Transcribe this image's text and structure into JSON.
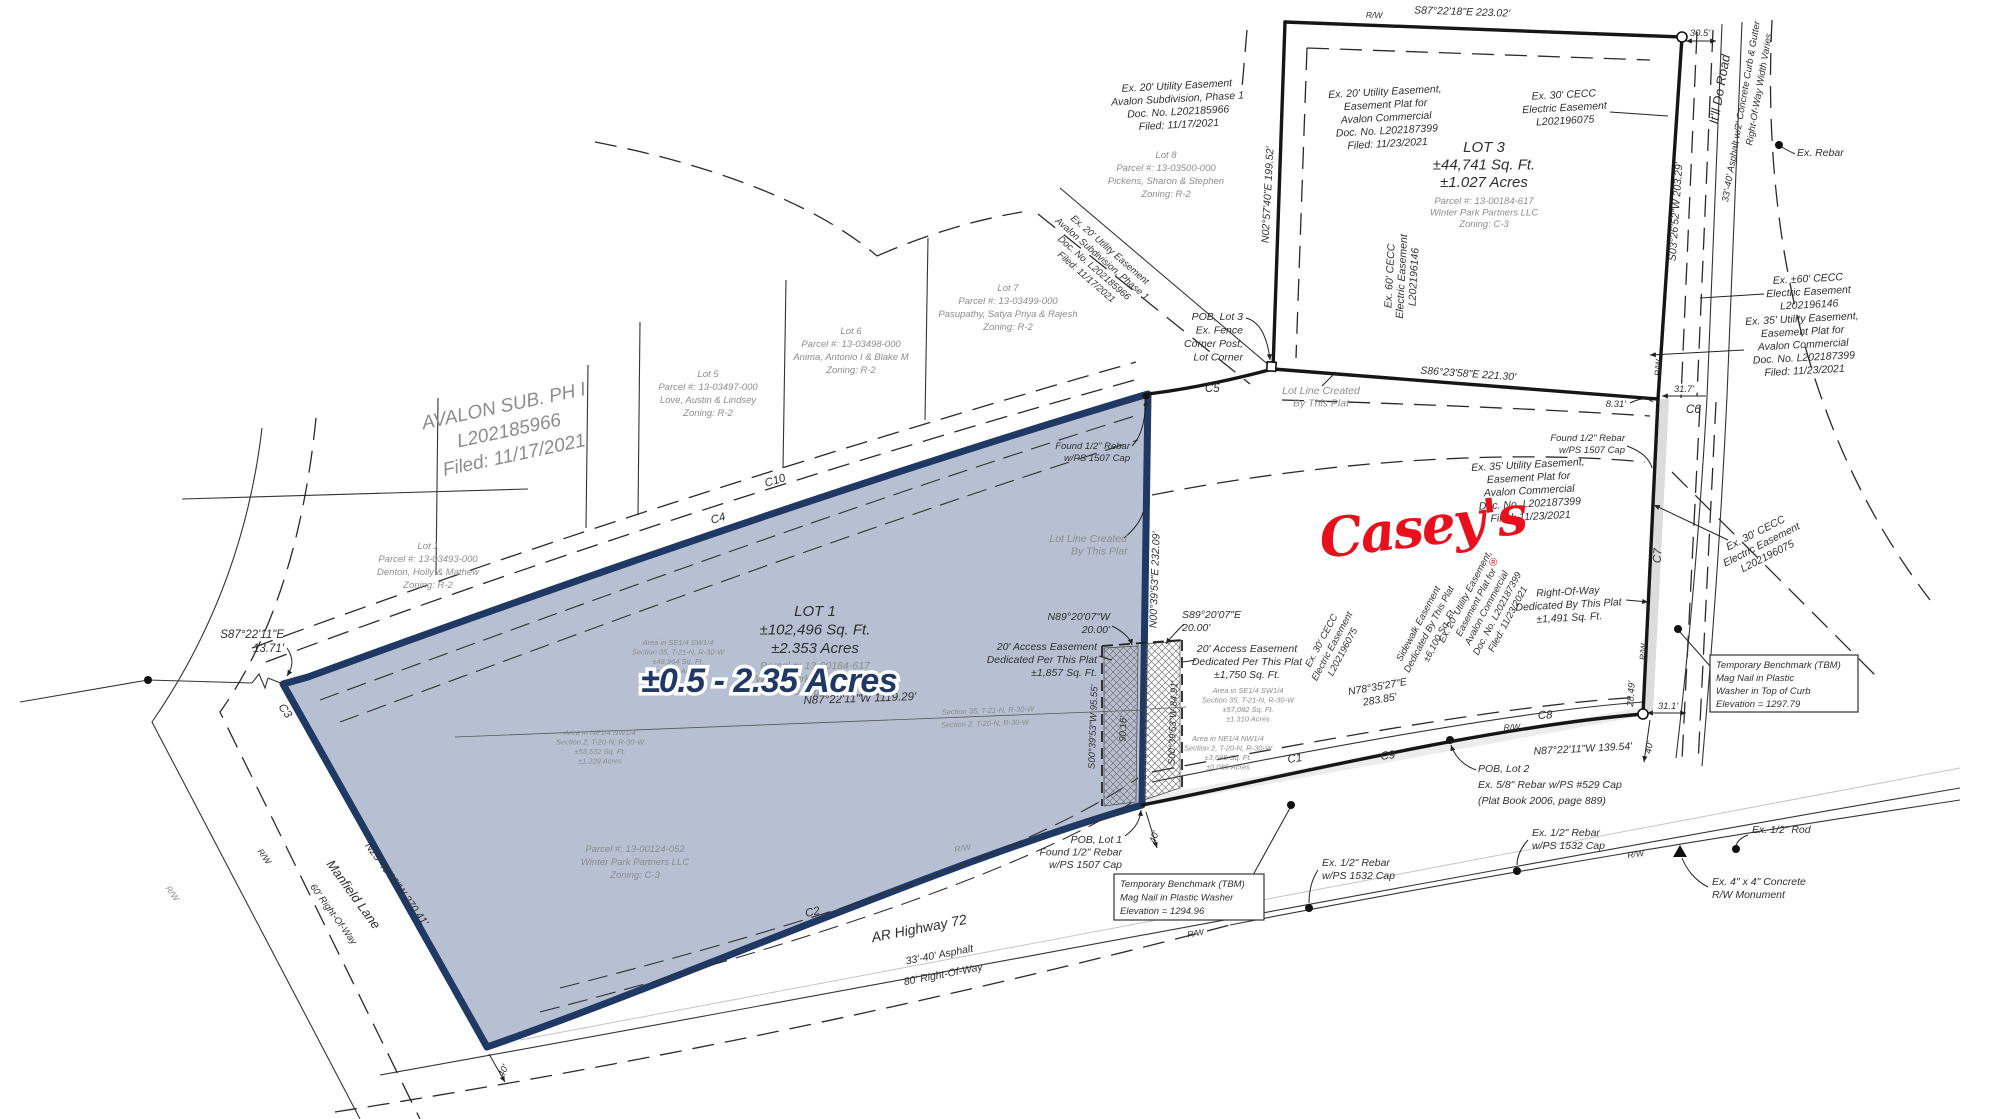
{
  "colors": {
    "lot_fill": "#b7c0d2",
    "lot_border": "#1f3864",
    "banner_navy": "#1f3864",
    "casey_red": "#e8101c",
    "gray_text": "#8c8c8c",
    "dark_text": "#2f2f2f"
  },
  "banner": {
    "text": "±0.5 - 2.35 Acres"
  },
  "brand": {
    "casey": "Casey's",
    "reg": "®"
  },
  "subdivision": {
    "avalon": [
      "AVALON SUB. PH I",
      "L202185966",
      "Filed: 11/17/2021"
    ]
  },
  "res_lots": {
    "lot1": [
      "Lot 1",
      "Parcel #: 13-03493-000",
      "Denton, Holly & Mathew",
      "Zoning: R-2"
    ],
    "lot5": [
      "Lot 5",
      "Parcel #: 13-03497-000",
      "Love, Austin & Lindsey",
      "Zoning: R-2"
    ],
    "lot6": [
      "Lot 6",
      "Parcel #: 13-03498-000",
      "Anima, Antonio I & Blake M",
      "Zoning: R-2"
    ],
    "lot7": [
      "Lot 7",
      "Parcel #: 13-03499-000",
      "Pasupathy, Satya Priya & Rajesh",
      "Zoning: R-2"
    ],
    "lot8": [
      "Lot 8",
      "Parcel #: 13-03500-000",
      "Pickens, Sharon & Stephen",
      "Zoning: R-2"
    ]
  },
  "lot1": {
    "title": [
      "LOT 1",
      "±102,496 Sq. Ft.",
      "±2.353 Acres"
    ],
    "sub": [
      "Parcel #: 13-00184-617",
      "Winter Park Partners LLC",
      "Zoning: C-3"
    ],
    "area_se": [
      "Area in SE1/4 SW1/4",
      "Section 35, T-21-N, R-30-W",
      "±48,964 Sq. Ft.",
      "±1.124 Acres"
    ],
    "area_ne": [
      "Area in NE1/4 NW1/4",
      "Section 2, T-20-N, R-30-W",
      "±53,532 Sq. Ft.",
      "±1.229 Acres"
    ],
    "parcel_low": [
      "Parcel #: 13-00124-052",
      "Winter Park Partners LLC",
      "Zoning: C-3"
    ]
  },
  "lot2": {
    "area_se": [
      "Area in SE1/4 SW1/4",
      "Section 35, T-21-N, R-30-W",
      "±57,082 Sq. Ft.",
      "±1.310 Acres"
    ],
    "area_ne": [
      "Area in NE1/4 NW1/4",
      "Section 2, T-20-N, R-30-W",
      "±3,698 Sq. Ft.",
      "±0.085 Acres"
    ]
  },
  "lot3": {
    "title": [
      "LOT 3",
      "±44,741 Sq. Ft.",
      "±1.027 Acres"
    ],
    "sub": [
      "Parcel #: 13-00184-617",
      "Winter Park Partners LLC",
      "Zoning: C-3"
    ]
  },
  "easements": {
    "ph1_top": [
      "Ex. 20' Utility Easement",
      "Avalon Subdivision, Phase 1",
      "Doc. No. L202185966",
      "Filed: 11/17/2021"
    ],
    "ph1_diag": [
      "Ex. 20' Utility Easement",
      "Avalon Subdivision, Phase 1",
      "Doc. No. L202185966",
      "Filed: 11/17/2021"
    ],
    "lot3_20": [
      "Ex. 20' Utility Easement,",
      "Easement Plat for",
      "Avalon Commercial",
      "Doc. No. L202187399",
      "Filed: 11/23/2021"
    ],
    "lot3_cecc30": [
      "Ex. 30' CECC",
      "Electric Easement",
      "L202196075"
    ],
    "cecc60_right": [
      "Ex. ±60' CECC",
      "Electric Easement",
      "L202196146"
    ],
    "cecc60_vert": [
      "Ex. 60' CECC",
      "Electric Easement",
      "L202196146"
    ],
    "util35_a": [
      "Ex. 35' Utility Easement,",
      "Easement Plat for",
      "Avalon Commercial",
      "Doc. No. L202187399",
      "Filed: 11/23/2021"
    ],
    "util35_b": [
      "Ex. 35' Utility Easement,",
      "Easement Plat for",
      "Avalon Commercial",
      "Doc. No. L202187399",
      "Filed: 11/23/2021"
    ],
    "cecc30_diag": [
      "Ex. 30' CECC",
      "Electric Easement",
      "L202196075"
    ],
    "cecc30_rot": [
      "Ex. 30' CECC",
      "Electric Easement",
      "L202196075"
    ],
    "util20_rot": [
      "Ex. 20' Utility Easement,",
      "Easement Plat for",
      "Avalon Commercial",
      "Doc. No. L202187399",
      "Filed: 11/23/2021"
    ],
    "sidewalk": [
      "Sidewalk Easement",
      "Dedicated By This Plat",
      "±6,100 Sq. Ft."
    ],
    "access_w": [
      "20' Access Easement",
      "Dedicated Per This Plat",
      "±1,857 Sq. Ft."
    ],
    "access_e": [
      "20' Access Easement",
      "Dedicated Per This Plat",
      "±1,750 Sq. Ft."
    ],
    "row_ded": [
      "Right-Of-Way",
      "Dedicated By This Plat",
      "±1,491 Sq. Ft."
    ]
  },
  "bearings": {
    "s87_top": "S87°22'18\"E 223.02'",
    "n02": "N02°57'40\"E 199.52'",
    "s03_right": "S03°26'52\"W 203.29'",
    "s86": "S86°23'58\"E 221.30'",
    "s03_0620": "S03°06'20\"W 183.71'",
    "n00": "N00°39'53\"E 232.09'",
    "n87_1119": "N87°22'11\"W 1119.29'",
    "n87_139": "N87°22'11\"W 139.54'",
    "n78": [
      "N78°35'27\"E",
      "283.85'"
    ],
    "n89": [
      "N89°20'07\"W",
      "20.00'"
    ],
    "s89": [
      "S89°20'07\"E",
      "20.00'"
    ],
    "s00_9555": "S00°39'53\"W 95.55'",
    "s00_8491": "S00°39'53\"W 84.91'",
    "d9016": "90.16'",
    "s87_left": [
      "S87°22'11\"E",
      "13.71'"
    ],
    "n25": "N25°40'16\"W 270.41'"
  },
  "dims": {
    "d305": "30.5'",
    "d317": "31.7'",
    "d831": "8.31'",
    "d311": "31.1'",
    "d2849": "28.49'",
    "d40": "40'"
  },
  "curves": {
    "c1": "C1",
    "c2": "C2",
    "c3": "C3",
    "c4": "C4",
    "c5": "C5",
    "c6": "C6",
    "c7": "C7",
    "c8": "C8",
    "c9": "C9",
    "c10": "C10"
  },
  "roads": {
    "itll": "It'll Do Road",
    "itll_sub": "33'-40' Asphalt w/2' Concrete Curb & Gutter",
    "itll_row": "Right-Of-Way Width Varies",
    "hw": "AR Highway 72",
    "hw_sub": [
      "33'-40' Asphalt",
      "80' Right-Of-Way"
    ],
    "manfield": "Manfield Lane",
    "manfield_row": "60' Right-Of-Way",
    "rw": "R/W"
  },
  "monuments": {
    "ex_rebar": "Ex. Rebar",
    "found_ne": [
      "Found 1/2\" Rebar",
      "w/PS 1507 Cap"
    ],
    "found_right": [
      "Found 1/2\" Rebar",
      "w/PS 1507 Cap"
    ],
    "pob1": [
      "POB, Lot 1",
      "Found 1/2\" Rebar",
      "w/PS 1507 Cap"
    ],
    "pob2": [
      "POB, Lot 2",
      "Ex. 5/8\" Rebar w/PS #529 Cap",
      "(Plat Book 2006, page 889)"
    ],
    "pob3": [
      "POB, Lot 3",
      "Ex. Fence",
      "Corner Post,",
      "Lot Corner"
    ],
    "reb1532a": [
      "Ex. 1/2\" Rebar",
      "w/PS 1532 Cap"
    ],
    "reb1532b": [
      "Ex. 1/2\" Rebar",
      "w/PS 1532 Cap"
    ],
    "rod": "Ex. 1/2\" Rod",
    "monument": [
      "Ex. 4\" x 4\" Concrete",
      "R/W Monument"
    ]
  },
  "benchmarks": {
    "top": [
      "Temporary Benchmark (TBM)",
      "Mag Nail in Plastic",
      "Washer in Top of Curb",
      "Elevation = 1297.79"
    ],
    "bottom": [
      "Temporary Benchmark (TBM)",
      "Mag Nail in Plastic Washer",
      "Elevation = 1294.96"
    ]
  },
  "notes": {
    "lotline_a": [
      "Lot Line Created",
      "By This Plat"
    ],
    "lotline_b": [
      "Lot Line Created",
      "By This Plat"
    ],
    "sec35": "Section 35, T-21-N, R-30-W",
    "sec2": "Section 2, T-20-N, R-30-W"
  }
}
